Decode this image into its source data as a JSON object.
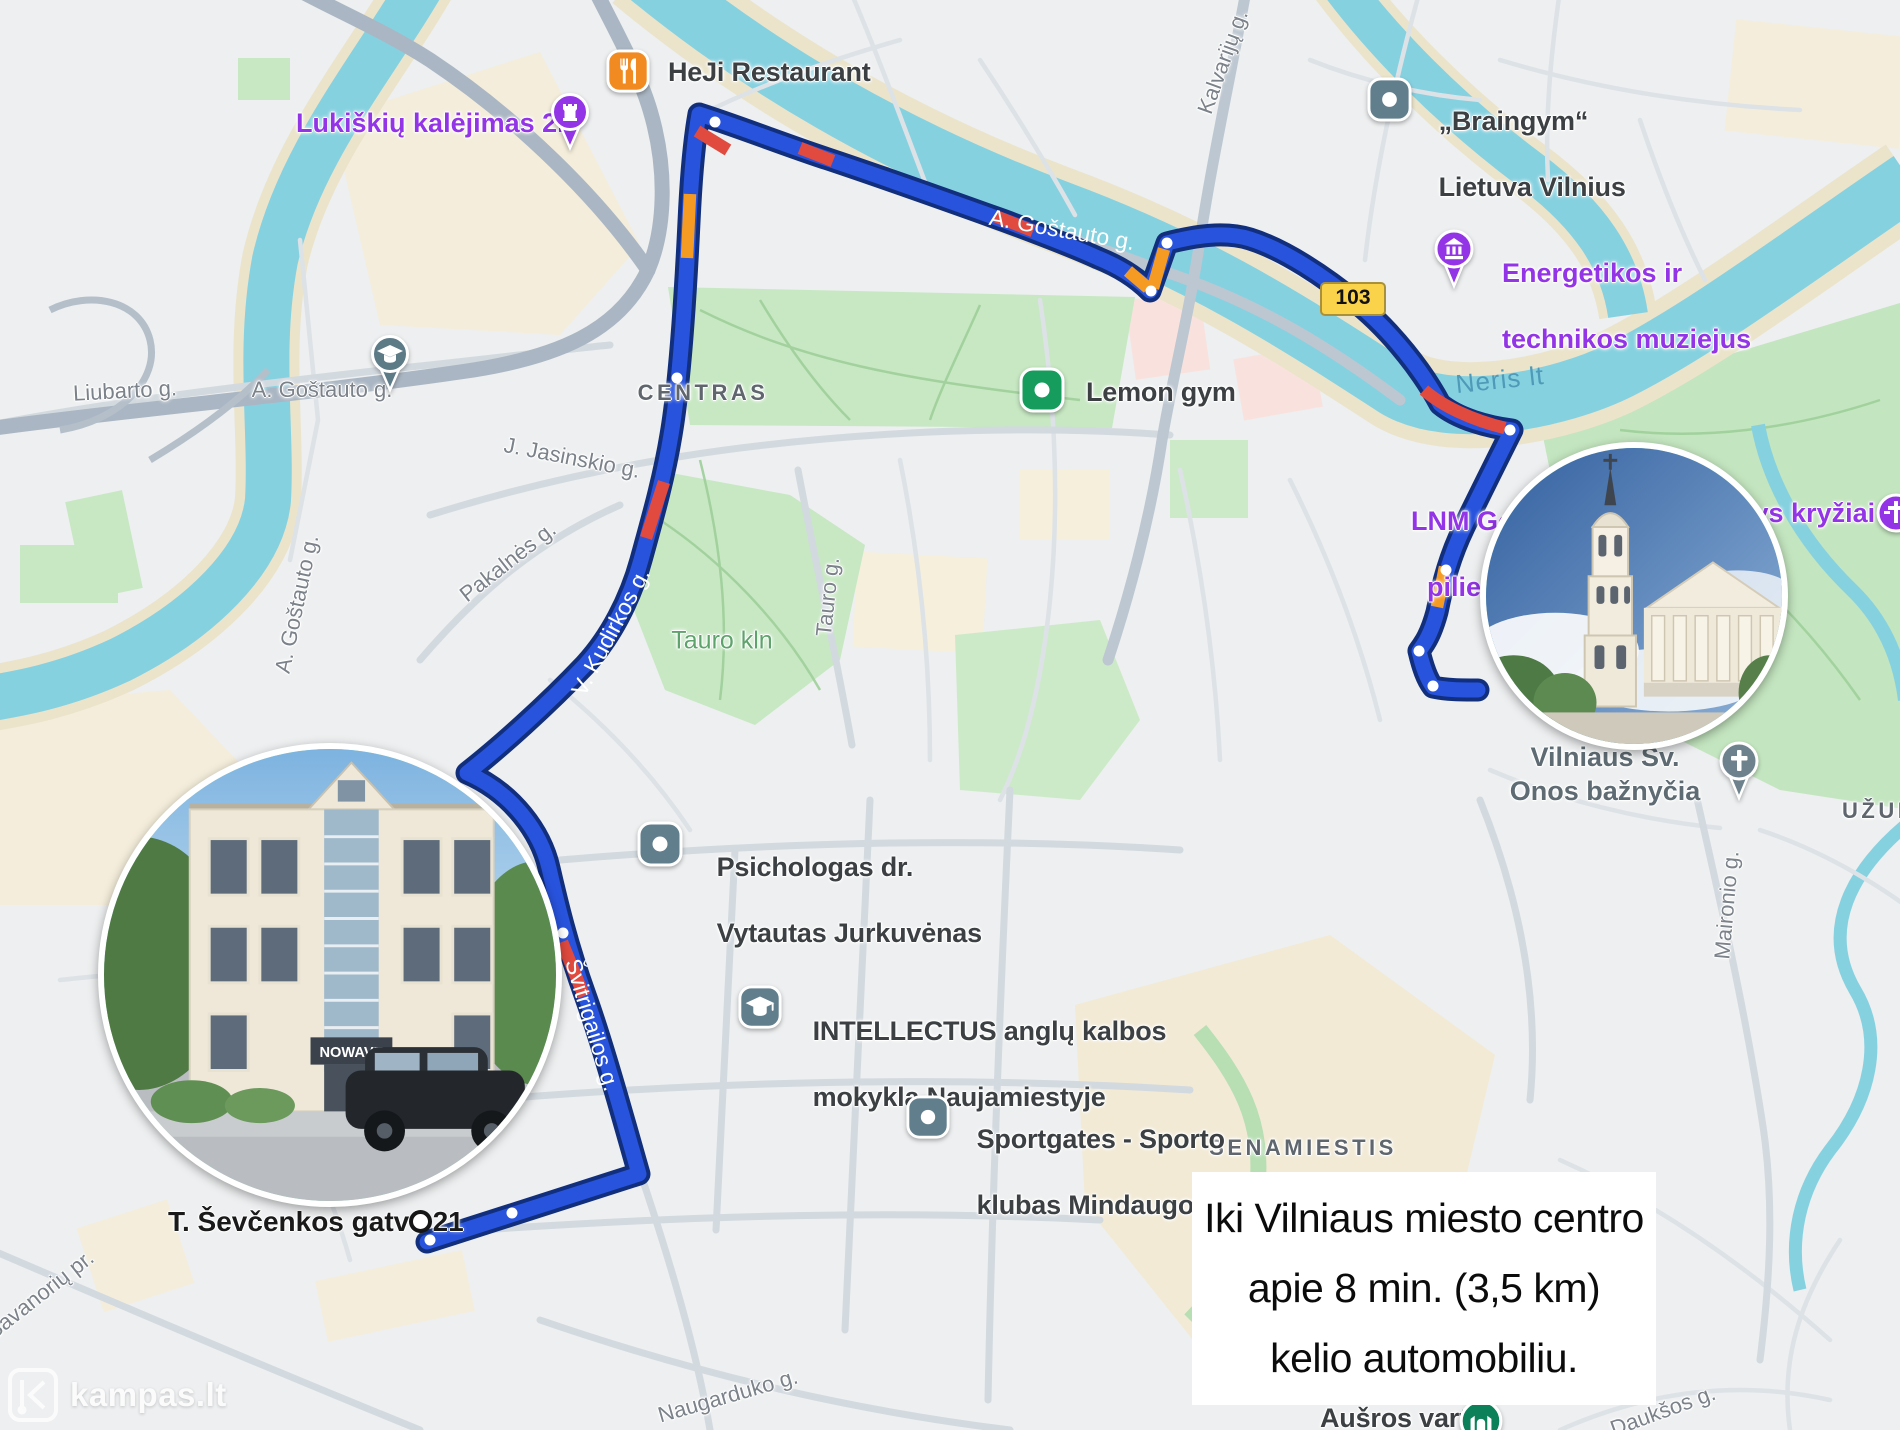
{
  "info_box": {
    "line1": "Iki Vilniaus miesto centro",
    "line2": "apie 8 min. (3,5 km)",
    "line3": "kelio automobiliu."
  },
  "watermark": {
    "text": "kampas.lt"
  },
  "route": {
    "badge": "103",
    "start_label": "T. Ševčenkos gatvė 21",
    "street_labels": [
      "A. Goštauto g.",
      "V. Kudirkos g.",
      "Švitrigailos g."
    ],
    "colors": {
      "line": "#2853dd",
      "casing": "#112f7d",
      "traffic_orange": "#f59b23",
      "traffic_red": "#e04a3f"
    }
  },
  "areas": [
    "CENTRAS",
    "SENAMIESTIS",
    "UŽUPIS"
  ],
  "water_label": "Neris lt",
  "park_label": "Tauro kln",
  "pois": [
    {
      "line1": "HeJi Restaurant",
      "line2": "",
      "icon": "restaurant"
    },
    {
      "line1": "Lukiškių kalėjimas 2.0",
      "line2": "",
      "icon": "castle-pin"
    },
    {
      "line1": "„Braingym“",
      "line2": "Lietuva Vilnius",
      "icon": "dot-square"
    },
    {
      "line1": "Energetikos ir",
      "line2": "technikos muziejus",
      "icon": "museum-pin"
    },
    {
      "line1": "Lemon gym",
      "line2": "",
      "icon": "dot-square-green"
    },
    {
      "line1": "LNM Gedi",
      "line2": "pilies",
      "icon": ""
    },
    {
      "line1": "Trys kryžiai",
      "line2": "",
      "icon": "crosses-pin"
    },
    {
      "line1": "Vilniaus Sv.",
      "line2": "Onos bažnyčia",
      "icon": "church-pin"
    },
    {
      "line1": "Psichologas dr.",
      "line2": "Vytautas Jurkuvėnas",
      "icon": "dot-square"
    },
    {
      "line1": "INTELLECTUS anglų kalbos",
      "line2": "mokykla Naujamiestyje",
      "icon": "school-square"
    },
    {
      "line1": "Sportgates - Sporto",
      "line2": "klubas Mindaugo",
      "icon": "dot-square"
    },
    {
      "line1": "Aušros vartai",
      "line2": "",
      "icon": "gate-circle"
    }
  ],
  "streets": [
    {
      "name": "Liubarto g."
    },
    {
      "name": "A. Goštauto g."
    },
    {
      "name": "A. Goštauto g."
    },
    {
      "name": "Kalvarijų g."
    },
    {
      "name": "J. Jasinskio g."
    },
    {
      "name": "Pakalnės g."
    },
    {
      "name": "Tauro g."
    },
    {
      "name": "Savanorių pr."
    },
    {
      "name": "Naugarduko g."
    },
    {
      "name": "Maironio g."
    },
    {
      "name": "Daukšos g."
    }
  ],
  "photo_building_sign": "NOWAVE"
}
